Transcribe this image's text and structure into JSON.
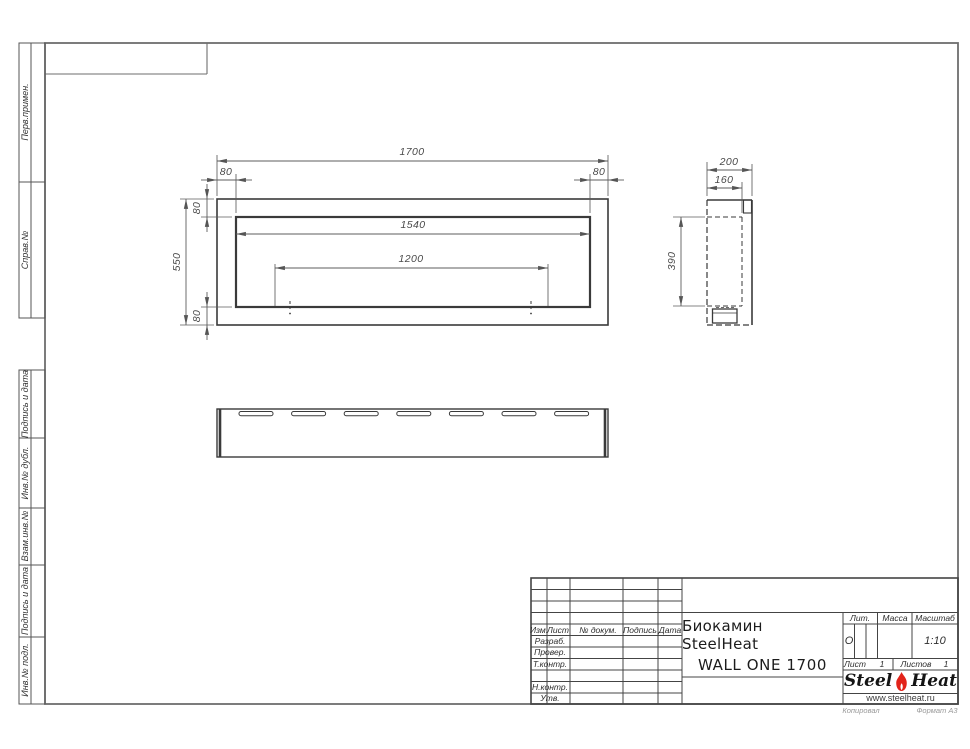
{
  "left_stamp": {
    "labels": [
      "Перв.примен.",
      "Справ.№",
      "Подпись и дата",
      "Инв.№ дубл.",
      "Взам.инв.№",
      "Подпись и дата",
      "Инв.№ подл."
    ]
  },
  "front_view": {
    "dim_total_width": "1700",
    "dim_flange_left": "80",
    "dim_flange_right": "80",
    "dim_inner_width": "1540",
    "dim_burner_length": "1200",
    "dim_total_height": "550",
    "dim_flange_top": "80",
    "dim_flange_bottom": "80"
  },
  "side_view": {
    "dim_depth": "200",
    "dim_inner_depth": "160",
    "dim_inner_height": "390"
  },
  "title_block": {
    "col_izm": "Изм.",
    "col_list": "Лист",
    "col_doc": "№ докум.",
    "col_sign": "Подпись",
    "col_date": "Дата",
    "row_razrab": "Разраб.",
    "row_prover": "Провер.",
    "row_tkontr": "Т.контр.",
    "row_nkontr": "Н.контр.",
    "row_utv": "Утв.",
    "title_line1": "Биокамин SteelHeat",
    "title_line2": "WALL ONE 1700",
    "lit_label": "Лит.",
    "lit_value": "О",
    "mass_label": "Масса",
    "scale_label": "Масштаб",
    "scale_value": "1:10",
    "list_label": "Лист",
    "list_value": "1",
    "listov_label": "Листов",
    "listov_value": "1"
  },
  "logo": {
    "word1": "Steel",
    "word2": "Heat",
    "url": "www.steelheat.ru",
    "flame_color": "#e2231a"
  },
  "footer": {
    "copy_label": "Копировал",
    "format_label": "Формат А3"
  }
}
